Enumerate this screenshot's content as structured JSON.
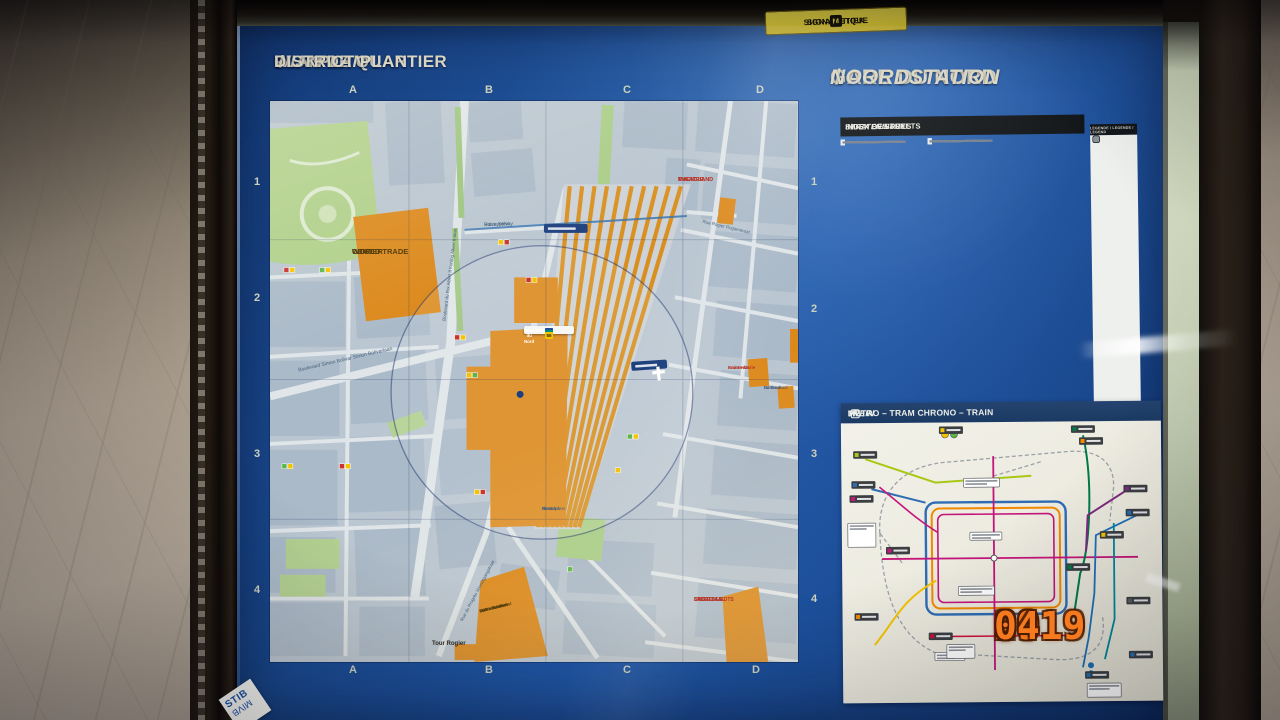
{
  "camera": {
    "timestamp": {
      "year": "2019",
      "month": "09",
      "day": "04"
    }
  },
  "frame_sticker": {
    "left": "SIGNALETIQUE",
    "logo": "M",
    "right": "SIGNALETIEK"
  },
  "titles": {
    "plan": {
      "fr": "PLAN DE QUARTIER",
      "nl": "WIJKPLAN",
      "en": "DISTRICT PLAN",
      "sep": "/"
    },
    "station": {
      "fr": "GARE DU NORD",
      "nl": "NOORDSTATION",
      "sep": "/"
    }
  },
  "map_grid": {
    "cols": [
      "A",
      "B",
      "C",
      "D"
    ],
    "rows": [
      "1",
      "2",
      "3",
      "4"
    ]
  },
  "map_labels": {
    "wtc": [
      "WTC 1 -",
      "WORLD TRADE",
      "CENTER"
    ],
    "magic_land": [
      "MAGIC LAND",
      "THEATRE",
      "MAGIC LAND",
      "THEATER"
    ],
    "salle_sports": [
      "SALLE DES",
      "SPORTS LIEDTS",
      "SPORTZAAL",
      "LIEDTS"
    ],
    "spf": [
      "SPF - Service",
      "Public Fédéral",
      "FOD - Federale",
      "Overheidsdienst"
    ],
    "tour_rogier": [
      "Tour Rogier"
    ],
    "sainte_marie": [
      "Sainte-Marie",
      "Fraternité"
    ],
    "basisschool": [
      "Basisschool",
      "De Buurt"
    ],
    "place_solvay": [
      "Place Solvay",
      "Solvayplein"
    ],
    "place_nord": [
      "Place",
      "du Nord",
      "Noordplein"
    ],
    "bd_bolivar": [
      "Boulevard Simon Bolivar  Simon Bolivarlaan"
    ],
    "bd_albert": [
      "Boulevard du Roi Albert II  Koning Albert II-laan"
    ],
    "rue_progres": [
      "Rue du Progrès  Vooruitgangstraat"
    ],
    "rue_rogier": [
      "Rue Rogier  Rogierstraat"
    ]
  },
  "station_box": {
    "title": [
      "Gare du Nord",
      "Noordstation"
    ],
    "rows": [
      [
        {
          "t": "B",
          "c": "#c8332b",
          "tc": "#ffffff"
        },
        {
          "t": "S",
          "c": "#1d4fa0",
          "tc": "#ffffff"
        }
      ],
      [
        {
          "t": "20",
          "c": "#008f77",
          "tc": "#ffffff"
        },
        {
          "t": "47",
          "c": "#008f77",
          "tc": "#ffffff"
        }
      ],
      [
        {
          "t": "3",
          "c": "#f3c300",
          "tc": "#222222"
        },
        {
          "t": "4",
          "c": "#c8332b",
          "tc": "#ffffff"
        },
        {
          "t": "25",
          "c": "#f3c300",
          "tc": "#222222"
        },
        {
          "t": "55",
          "c": "#f3c300",
          "tc": "#222222"
        }
      ]
    ]
  },
  "index_panel": {
    "title": {
      "fr": "INDEX DES RUES",
      "nl": "STRATENINDEX",
      "en": "INDEX OF STREETS",
      "sep": "/"
    },
    "columns": [
      {
        "sections": [
          6,
          7,
          3,
          4,
          2,
          5
        ]
      },
      {
        "sections": [
          2,
          4,
          6,
          1,
          3,
          4,
          2
        ]
      },
      {
        "striped_rows": 36
      }
    ]
  },
  "legend_panel": {
    "title": "LEGENDE / LEGENDE / LEGEND",
    "items": [
      "#1d4fa0",
      "#5cb54a",
      "#979ca0",
      "#8b9094",
      "#9aa0a4",
      "#c8332b",
      "#c8332b",
      "#c8332b",
      "#e8e8e8",
      "#3a3a3a",
      "#e0a42c",
      "#a97c3a",
      "#c8a035",
      "#3f4648",
      "#1f4fa0",
      "#2b3a8f",
      "#d9d9d9",
      "#b23b2e",
      "#20508f",
      "#8d959b"
    ]
  },
  "metro_panel": {
    "title_main": "METRO – TRAM CHRONO – TRAIN",
    "sep": "/",
    "title_it": "TREIN",
    "suffix": "S"
  },
  "logo": {
    "line1": "STIB",
    "line2": "MIVB"
  },
  "colors": {
    "poster_blue": "#1c4e96",
    "map_orange": "#dc891c",
    "timestamp_orange": "#f5791f",
    "title_text": "#d9d5c2"
  }
}
